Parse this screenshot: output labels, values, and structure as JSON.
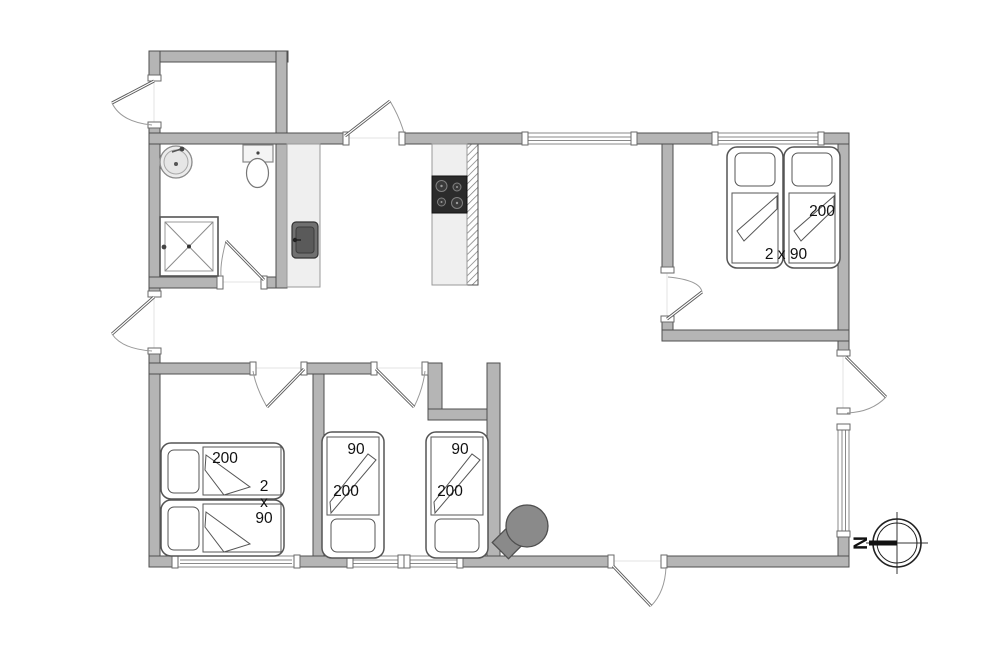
{
  "meta": {
    "type": "summer-house floor plan"
  },
  "colors": {
    "background": "#ffffff",
    "wall_fill": "#b5b5b5",
    "wall_stroke": "#4f4f4f",
    "counter_fill": "#efefef",
    "hob_fill": "#2b2b2b",
    "appliance_fill": "#707070",
    "wood_stove_fill": "#8a8a8a",
    "label_text": "#111111"
  },
  "labels": {
    "bedroom_right": {
      "bed_length": "200",
      "bed_size": "2 x 90"
    },
    "bedroom_left": {
      "bed_length": "200",
      "bed_count": "2",
      "bed_times": "x",
      "bed_width": "90"
    },
    "small_room_west": {
      "bed_width": "90",
      "bed_length": "200"
    },
    "small_room_east": {
      "bed_width": "90",
      "bed_length": "200"
    }
  },
  "compass": {
    "north": "N"
  },
  "fixtures": {
    "bathroom": [
      "washbasin-icon",
      "toilet-icon",
      "shower-icon"
    ],
    "kitchen": [
      "hob-icon",
      "kitchen-sink-icon"
    ],
    "living_room": [
      "wood-stove-icon"
    ],
    "navigation": [
      "compass-icon"
    ]
  }
}
